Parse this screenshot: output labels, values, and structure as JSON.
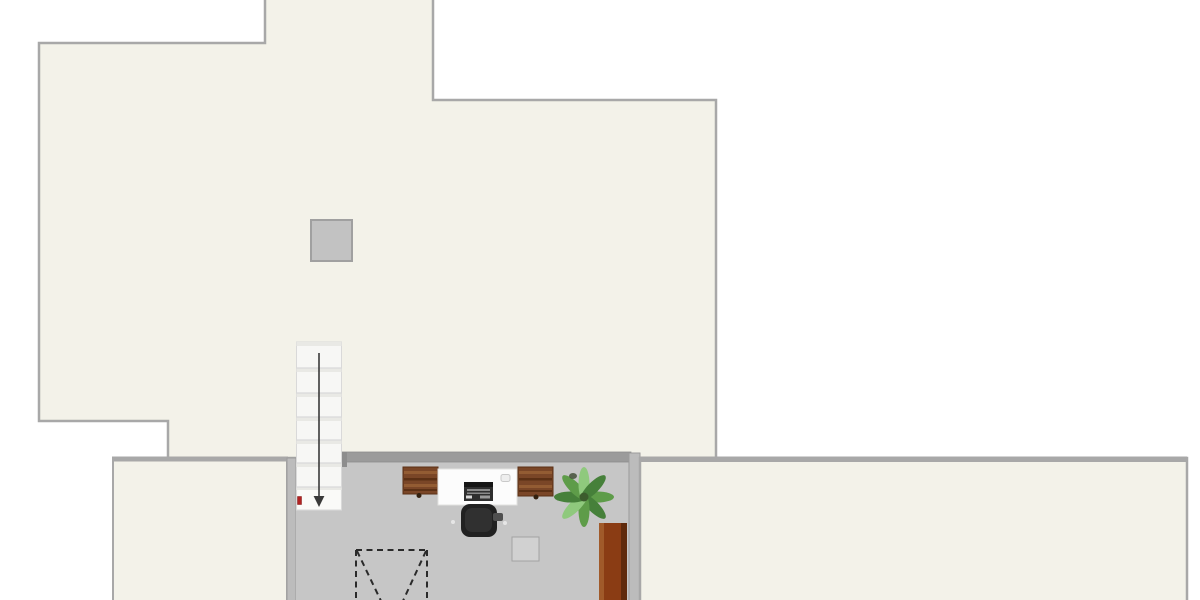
{
  "canvas": {
    "background": "#ffffff"
  },
  "colors": {
    "outside": "#ffffff",
    "floor_cream": "#f3f2e9",
    "floor_gray": "#c6c6c6",
    "wall": "#a8a8a8",
    "wall_dark": "#9b9b9b",
    "wall_mid": "#bcbcbc",
    "wall_tab": "#8d8d8d",
    "wall_edge": "#8c8c8c",
    "chimney_fill": "#c2c2c2",
    "chimney_stroke": "#a0a0a0",
    "stair_white": "#f7f7f5",
    "stair_shade": "#e9e9e5",
    "stair_landing": "#fafaf8",
    "stair_line": "#d9d9d9",
    "arrow": "#3a3a3a",
    "marker_red": "#b22222",
    "marker_red_dark": "#7e1414",
    "desk_wood": "#7a4627",
    "desk_wood_dark": "#5b3015",
    "desk_wood_light": "#935c33",
    "desk_knob": "#32200f",
    "desk_white": "#fcfcfc",
    "desk_white_stroke": "#e2e2e0",
    "printer_body": "#2f2f2f",
    "printer_top": "#161616",
    "printer_stripe": "#8a8a8a",
    "printer_button_light": "#d8d8d8",
    "printer_button_gray": "#9a9a9a",
    "gadget_fill": "#eeeeee",
    "gadget_stroke": "#c9c9c9",
    "chair_black": "#212121",
    "chair_inner": "#303030",
    "chair_arm": "#4f4f4f",
    "chair_wheel": "#e6e6e6",
    "stool_fill": "#d1d1d1",
    "stool_stroke": "#a3a3a3",
    "wardrobe_main": "#8a3c14",
    "wardrobe_light": "#a05a2a",
    "wardrobe_dark": "#5f2a0c",
    "plant_green": "#5e9c49",
    "plant_green_dark": "#46803a",
    "plant_green_light": "#8fc97d",
    "plant_center": "#3c5c2d",
    "plant_spot": "#44503a",
    "void_dash": "#2a2a2a"
  },
  "icons": {
    "stairs_direction": "down-arrow",
    "void_symbol": "dashed-x-box"
  },
  "objects": {
    "upper_floor": "upper-floor-area",
    "chimney": "chimney-block",
    "stairs": "staircase-down",
    "room_bottom_left": "lower-left-room",
    "room_center": "gray-studio-room",
    "room_bottom_right": "lower-right-room",
    "desk_left": "wood-desk-left",
    "desk_center": "white-desk",
    "printer": "printer-device",
    "gadget": "small-device",
    "desk_right": "wood-desk-right",
    "chair": "office-chair",
    "plant": "potted-palm-plant",
    "stool": "square-side-table",
    "wardrobe": "wood-wardrobe",
    "void": "open-to-below-void",
    "entry_marker": "red-entry-marker"
  }
}
